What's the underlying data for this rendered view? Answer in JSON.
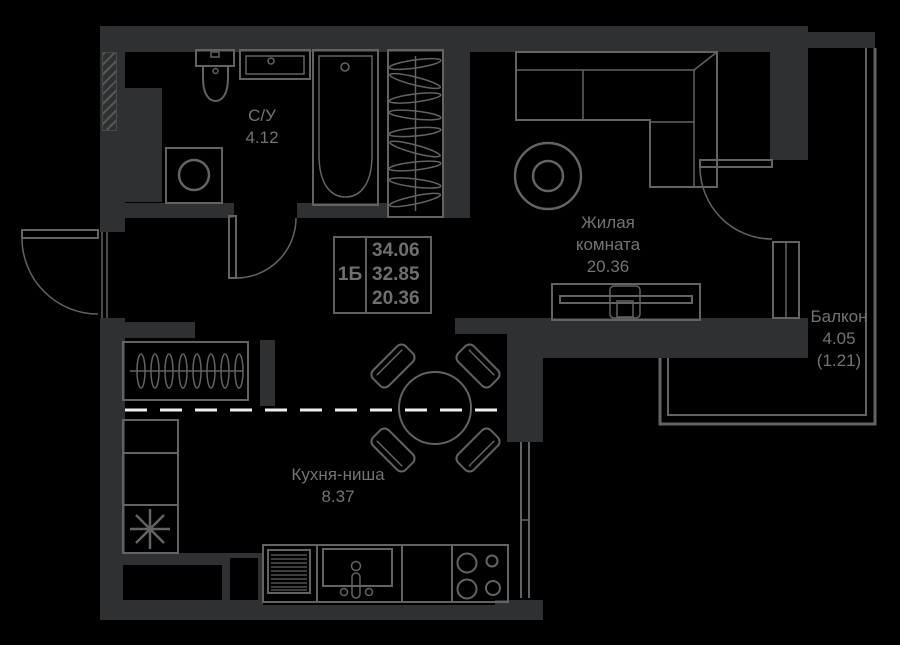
{
  "colors": {
    "background": "#000000",
    "wall": "#2f3031",
    "line": "#636363",
    "text": "#737373",
    "zone_line": "#eeeeee"
  },
  "unit": {
    "type": "1Б",
    "area_total": "34.06",
    "area_reduced": "32.85",
    "area_living": "20.36"
  },
  "rooms": {
    "bathroom": {
      "name": "С/У",
      "area": "4.12"
    },
    "living_room": {
      "name_line1": "Жилая",
      "name_line2": "комната",
      "area": "20.36"
    },
    "kitchen": {
      "name": "Кухня-ниша",
      "area": "8.37"
    },
    "balcony": {
      "name": "Балкон",
      "area": "4.05",
      "area_secondary": "(1.21)"
    }
  },
  "icons": {
    "fridge_symbol": "snowflake-asterisk"
  }
}
